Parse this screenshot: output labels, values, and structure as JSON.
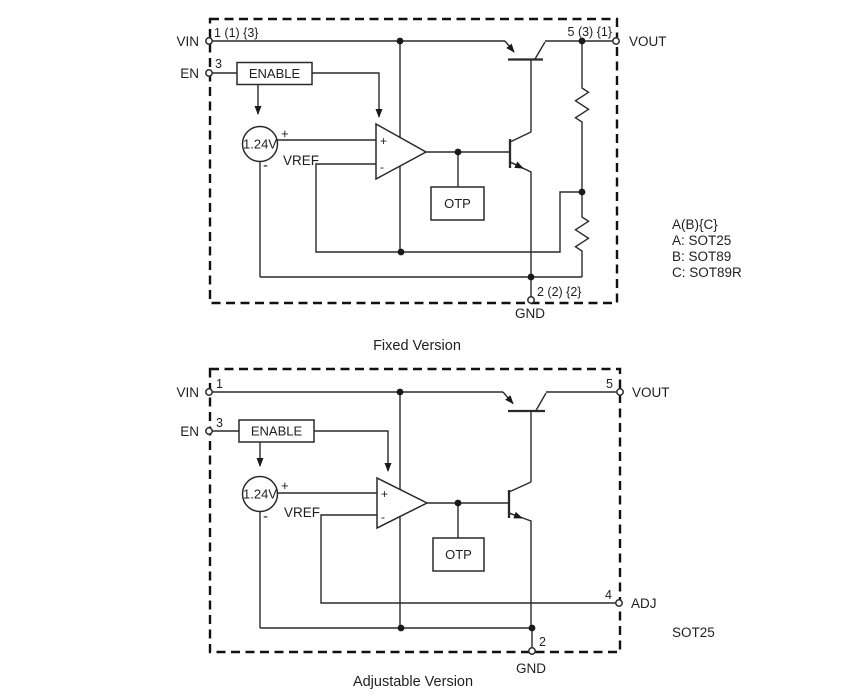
{
  "colors": {
    "line": "#2a2a2a",
    "background": "#ffffff"
  },
  "fixed": {
    "title": "Fixed Version",
    "pins": {
      "vin": {
        "label": "VIN",
        "number": "1 (1) {3}"
      },
      "en": {
        "label": "EN",
        "number": "3"
      },
      "vout": {
        "label": "VOUT",
        "number": "5 (3) {1}"
      },
      "gnd": {
        "label": "GND",
        "number": "2 (2) {2}"
      }
    },
    "blocks": {
      "enable": "ENABLE",
      "otp": "OTP"
    },
    "vref": {
      "value": "1.24V",
      "label": "VREF",
      "plus": "+",
      "minus": "-"
    },
    "opamp": {
      "plus": "+",
      "minus": "-"
    },
    "package_note": [
      "A(B){C}",
      "A: SOT25",
      "B: SOT89",
      "C: SOT89R"
    ]
  },
  "adjustable": {
    "title": "Adjustable Version",
    "pins": {
      "vin": {
        "label": "VIN",
        "number": "1"
      },
      "en": {
        "label": "EN",
        "number": "3"
      },
      "vout": {
        "label": "VOUT",
        "number": "5"
      },
      "adj": {
        "label": "ADJ",
        "number": "4"
      },
      "gnd": {
        "label": "GND",
        "number": "2"
      }
    },
    "blocks": {
      "enable": "ENABLE",
      "otp": "OTP"
    },
    "vref": {
      "value": "1.24V",
      "label": "VREF",
      "plus": "+",
      "minus": "-"
    },
    "opamp": {
      "plus": "+",
      "minus": "-"
    },
    "package_note": "SOT25"
  }
}
